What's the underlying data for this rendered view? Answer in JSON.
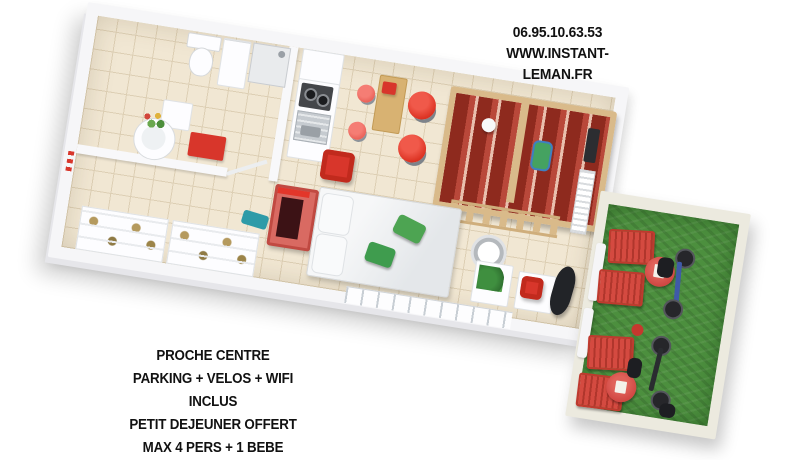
{
  "contact": {
    "phone": "06.95.10.63.53",
    "website": "WWW.INSTANT-LEMAN.FR"
  },
  "features": [
    "PROCHE CENTRE",
    "PARKING + VELOS + WIFI INCLUS",
    "PETIT DEJEUNER OFFERT",
    "MAX 4 PERS + 1 BEBE"
  ],
  "colors": {
    "text": "#111111",
    "red": "#d8362b",
    "dark_red": "#8e2a1e",
    "grass": "#4c8f3e",
    "floor": "#f1e7d3",
    "grout": "#ddcfb4",
    "wall": "#f6f6f8",
    "wood": "#d9ba8a",
    "teal": "#2e9ba8"
  },
  "plan": {
    "view": "3d-top-down-studio-floor-plan",
    "rooms": [
      "bathroom",
      "dressing",
      "kitchen",
      "dining-area",
      "bunk-bed-corner",
      "sleeping-area",
      "desk-corner",
      "terrace"
    ],
    "furniture_icons": [
      "toilet",
      "shower",
      "washbasin-with-flowers",
      "bath-mat",
      "stove",
      "kitchen-sink",
      "dining-table",
      "red-chairs",
      "red-armchair",
      "bunk-bed",
      "ladder",
      "radiator",
      "wall-tv",
      "double-bed",
      "pillows",
      "green-cushions",
      "red-tv-cabinet",
      "ceiling-light",
      "plant-table",
      "desk-red-chair",
      "black-chaise",
      "wardrobe-shelves",
      "teal-rug",
      "sun-loungers",
      "round-tables",
      "bicycles"
    ]
  }
}
